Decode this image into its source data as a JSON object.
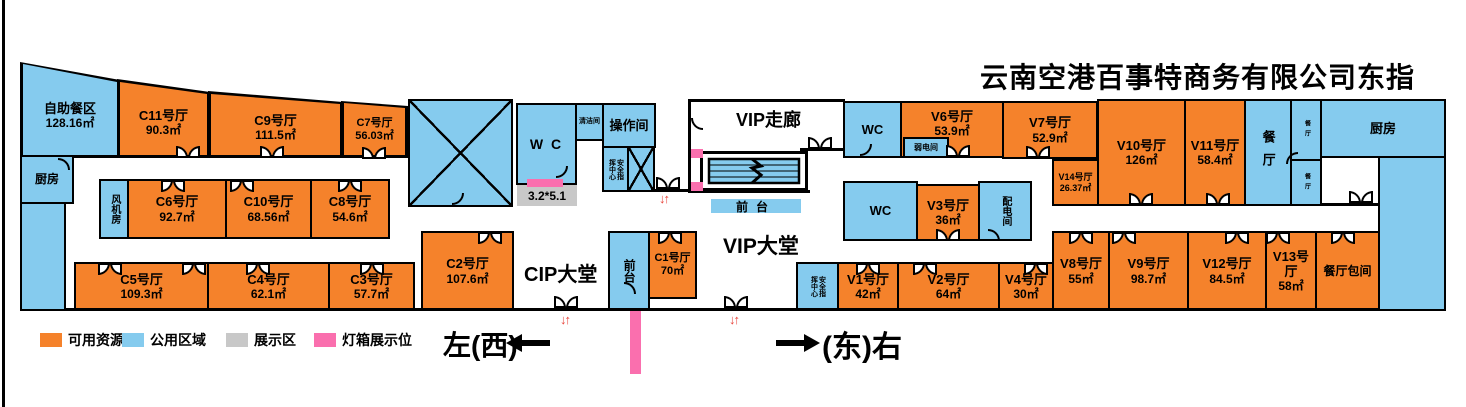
{
  "title": "云南空港百事特商务有限公司东指廊资源图",
  "legend": [
    {
      "label": "可用资源",
      "color": "#F5822B"
    },
    {
      "label": "公用区域",
      "color": "#85CBEE"
    },
    {
      "label": "展示区",
      "color": "#C8C8C8"
    },
    {
      "label": "灯箱展示位",
      "color": "#FA6FAE"
    }
  ],
  "directions": {
    "west": "左(西)",
    "east": "(东)右"
  },
  "icons": {
    "updown_arrows": "↓↑"
  },
  "areas": {
    "vip_corridor": "VIP走廊",
    "vip_lobby": "VIP大堂",
    "cip_lobby": "CIP大堂",
    "display_size": "3.2*5.1"
  },
  "rooms": {
    "buffet": {
      "name": "自助餐区",
      "area": "128.16㎡"
    },
    "kitchen_left": {
      "name": "厨房"
    },
    "fan_room": {
      "name": "风机房"
    },
    "c11": {
      "name": "C11号厅",
      "area": "90.3㎡"
    },
    "c9": {
      "name": "C9号厅",
      "area": "111.5㎡"
    },
    "c7": {
      "name": "C7号厅",
      "area": "56.03㎡"
    },
    "c6": {
      "name": "C6号厅",
      "area": "92.7㎡"
    },
    "c10": {
      "name": "C10号厅",
      "area": "68.56㎡"
    },
    "c8": {
      "name": "C8号厅",
      "area": "54.6㎡"
    },
    "c5": {
      "name": "C5号厅",
      "area": "109.3㎡"
    },
    "c4": {
      "name": "C4号厅",
      "area": "62.1㎡"
    },
    "c3": {
      "name": "C3号厅",
      "area": "57.7㎡"
    },
    "c2": {
      "name": "C2号厅",
      "area": "107.6㎡"
    },
    "c1": {
      "name": "C1号厅",
      "area": "70㎡"
    },
    "wc_mid": {
      "name": "W C"
    },
    "cleaning": {
      "name": "清洁间"
    },
    "operation": {
      "name": "操作间"
    },
    "security_top": {
      "name": "安全指挥中心"
    },
    "security_bottom": {
      "name": "安全指挥中心"
    },
    "reception_cip": {
      "name": "前台"
    },
    "reception_vip": {
      "name": "前台"
    },
    "wc_r1": {
      "name": "WC"
    },
    "weak_power": {
      "name": "弱电间"
    },
    "v6": {
      "name": "V6号厅",
      "area": "53.9㎡"
    },
    "v7": {
      "name": "V7号厅",
      "area": "52.9㎡"
    },
    "v14": {
      "name": "V14号厅",
      "area": "26.37㎡"
    },
    "v10": {
      "name": "V10号厅",
      "area": "126㎡"
    },
    "v11": {
      "name": "V11号厅",
      "area": "58.4㎡"
    },
    "dining": {
      "name": "餐厅"
    },
    "dining_s1": {
      "name": "餐厅"
    },
    "dining_s2": {
      "name": "餐厅"
    },
    "kitchen_right": {
      "name": "厨房"
    },
    "wc_r2": {
      "name": "WC"
    },
    "v3": {
      "name": "V3号厅",
      "area": "36㎡"
    },
    "power_dist": {
      "name": "配电间"
    },
    "v1": {
      "name": "V1号厅",
      "area": "42㎡"
    },
    "v2": {
      "name": "V2号厅",
      "area": "64㎡"
    },
    "v4": {
      "name": "V4号厅",
      "area": "30㎡"
    },
    "v8": {
      "name": "V8号厅",
      "area": "55㎡"
    },
    "v9": {
      "name": "V9号厅",
      "area": "98.7㎡"
    },
    "v12": {
      "name": "V12号厅",
      "area": "84.5㎡"
    },
    "v13": {
      "name": "V13号厅",
      "area": "58㎡"
    },
    "dining_private": {
      "name": "餐厅包间"
    }
  }
}
